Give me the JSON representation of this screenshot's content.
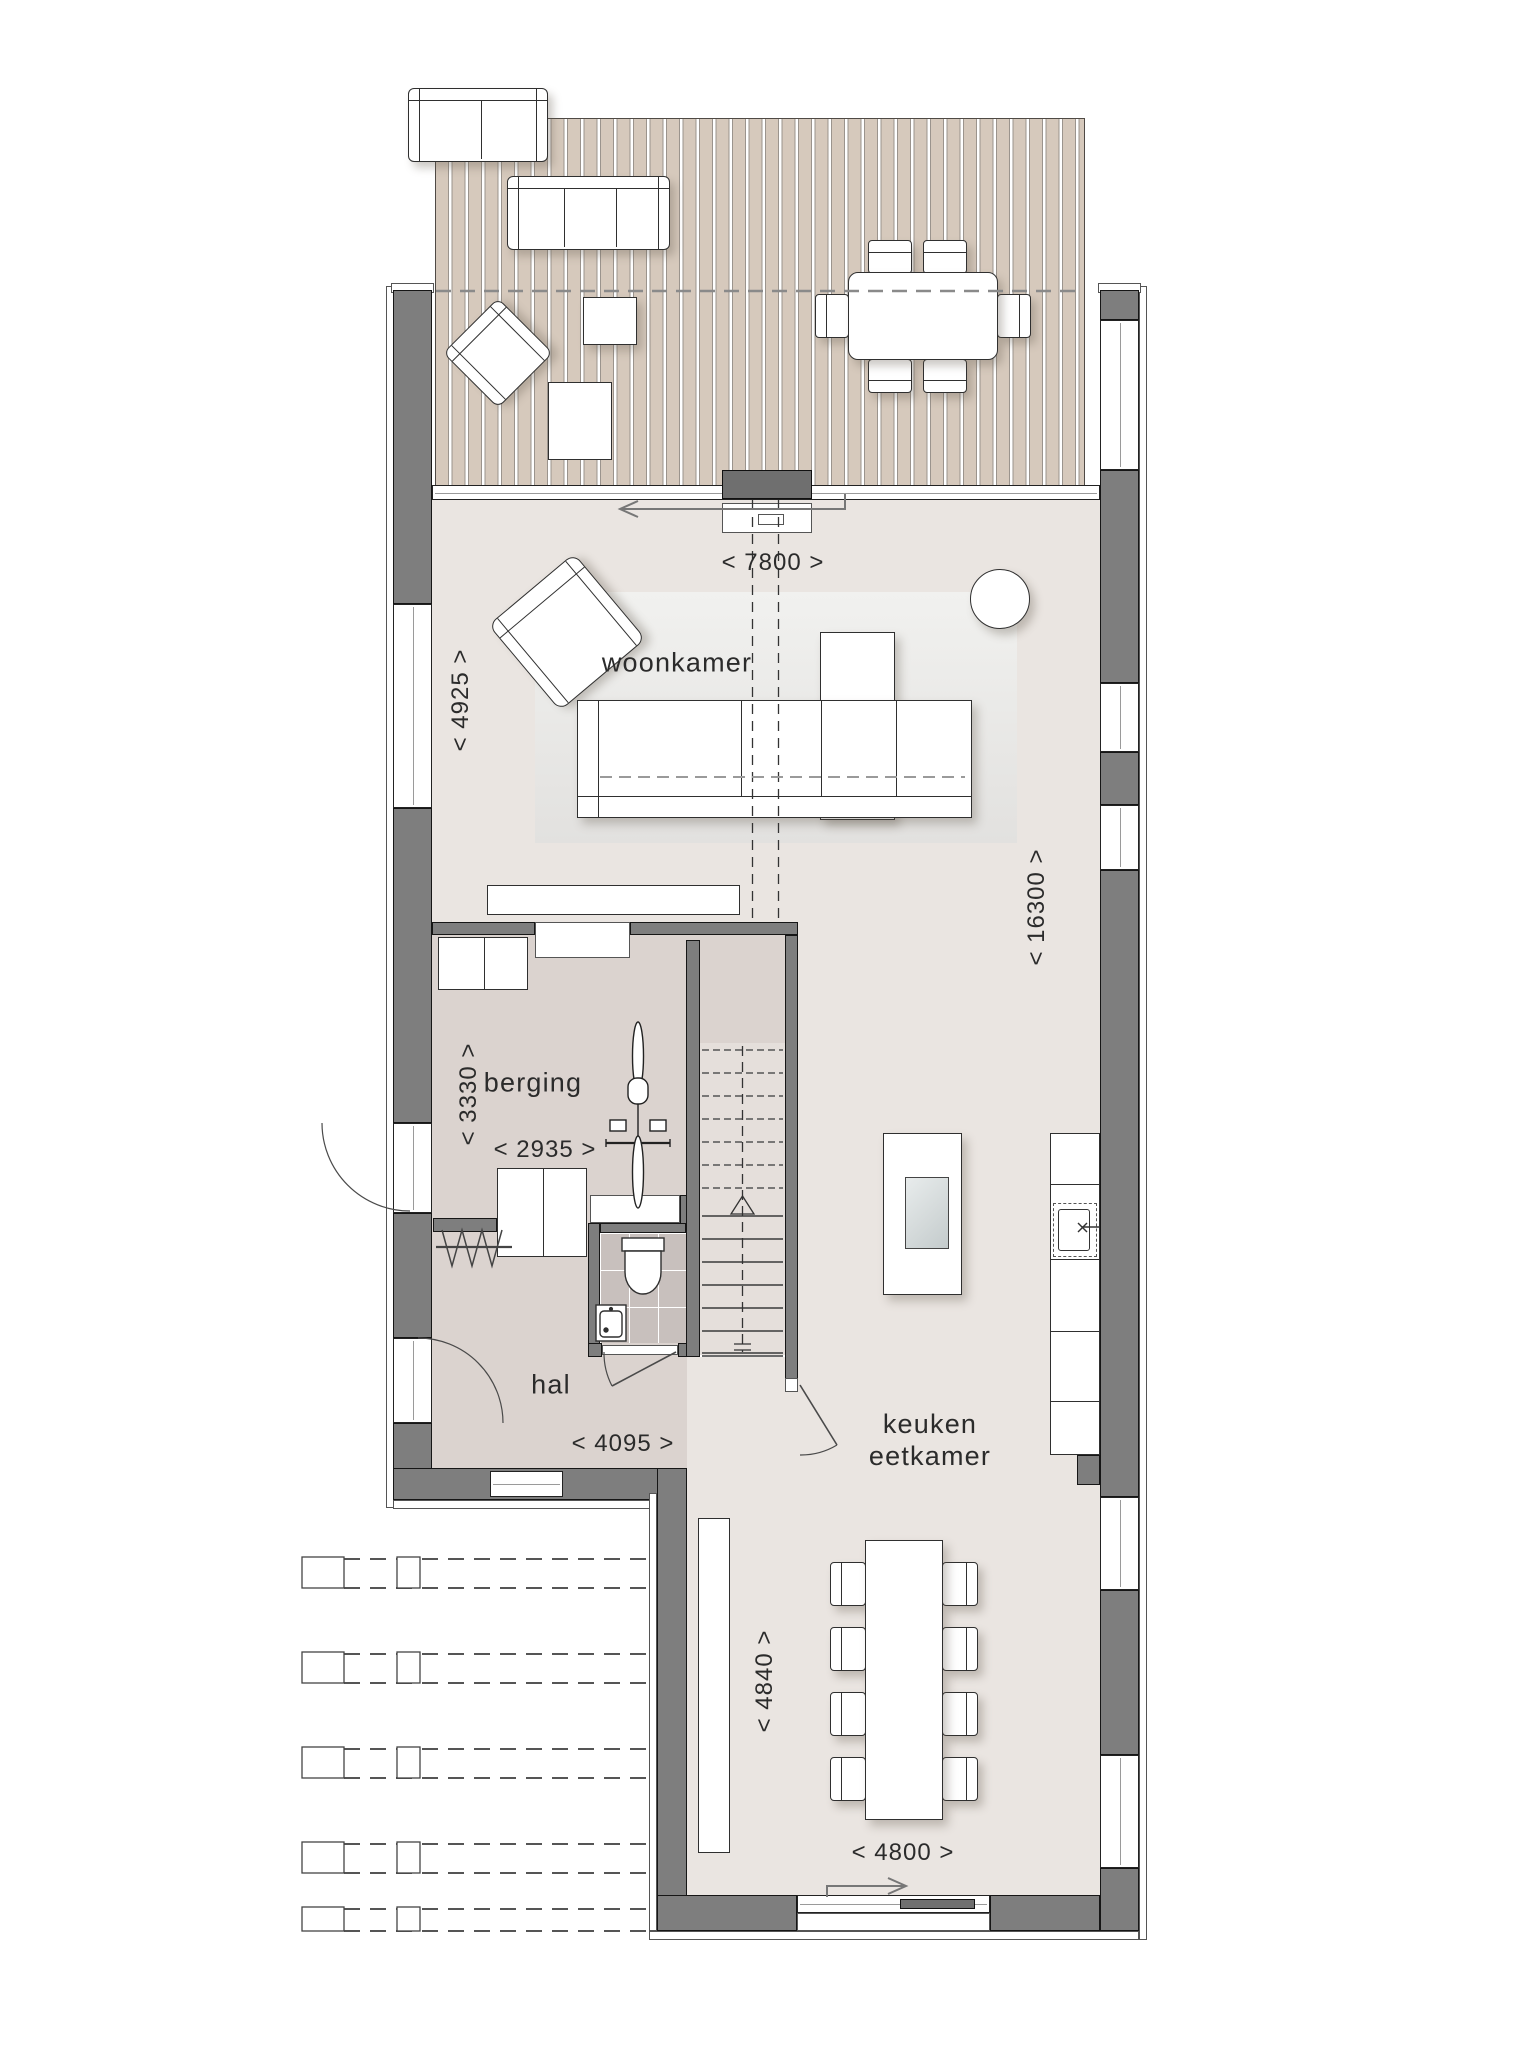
{
  "rooms": {
    "woonkamer": "woonkamer",
    "berging": "berging",
    "hal": "hal",
    "keuken_line1": "keuken",
    "keuken_line2": "eetkamer"
  },
  "dimensions": {
    "terras_breedte": "< 7800 >",
    "woonkamer_diepte": "< 4925 >",
    "woning_lengte": "< 16300 >",
    "berging_diepte": "< 3330 >",
    "berging_breedte": "< 2935 >",
    "hal_breedte": "< 4095 >",
    "eetkamer_diepte": "< 4840 >",
    "eetkamer_breedte": "< 4800 >"
  },
  "colors": {
    "wall": "#7e7e7e",
    "deck": "#d6c9bc",
    "floor_main": "#eae5e1",
    "floor_service": "#dbd3cf",
    "toilet_tile": "#c8c0bd",
    "outline": "#161616"
  },
  "icons": [
    "bike-icon",
    "toilet-icon",
    "sink-icon",
    "stairs-up-arrow-icon",
    "door-swing-arc-icon",
    "slide-direction-arrow-icon",
    "coat-rack-icon",
    "cooktop-icon",
    "kitchen-sink-icon"
  ]
}
